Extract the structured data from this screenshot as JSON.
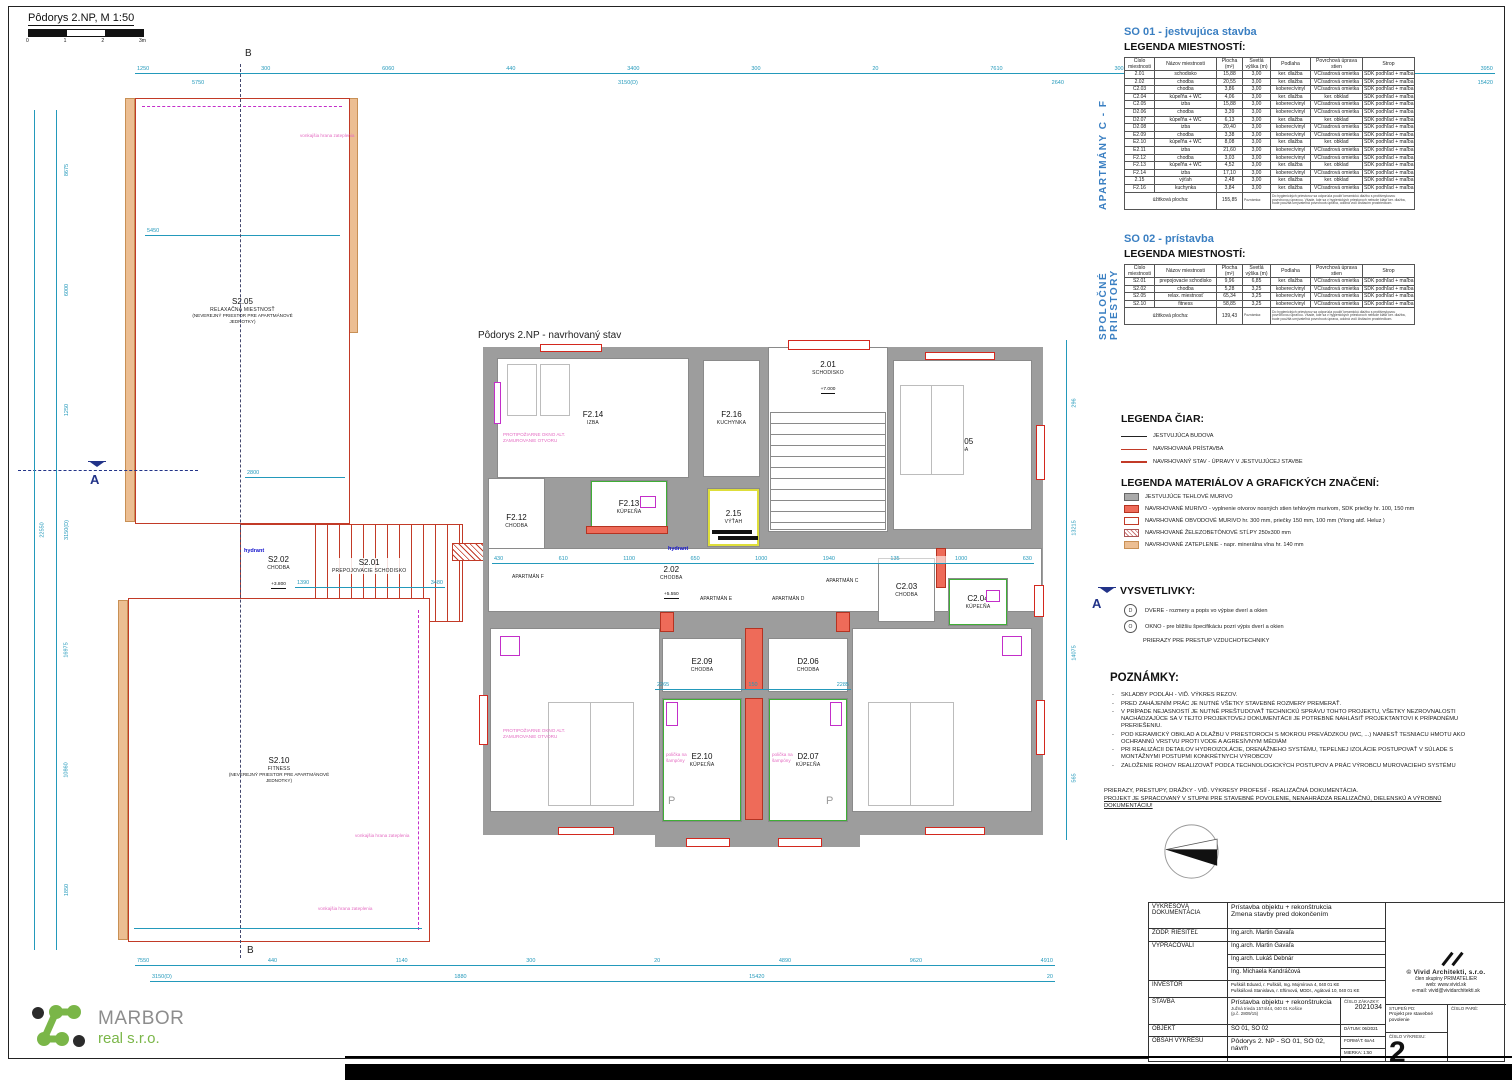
{
  "sheet": {
    "title": "Pôdorys 2.NP, M 1:50",
    "scale_ticks": [
      "0",
      "1",
      "2",
      "3m"
    ],
    "section_a": "A",
    "section_b": "B"
  },
  "plan_left": {
    "rooms": [
      {
        "id": "S2.05",
        "name": "RELAXAČNÁ MIESTNOSŤ",
        "sub": "(NEVEREJNÝ PRIESTOR PRE APARTMÁNOVÉ JEDNOTKY)"
      },
      {
        "id": "S2.02",
        "name": "CHODBA",
        "level": "+3.800"
      },
      {
        "id": "S2.01",
        "name": "PREPOJOVACIE SCHODISKO"
      },
      {
        "id": "S2.10",
        "name": "FITNESS",
        "sub": "(NEVEREJNÝ PRIESTOR PRE APARTMÁNOVÉ JEDNOTKY)"
      }
    ],
    "hydrant": "hydrant",
    "edge_note": "vonkajšia hrana zateplenia"
  },
  "plan_center": {
    "title": "Pôdorys 2.NP - navrhovaný stav",
    "rooms": [
      {
        "id": "F2.14",
        "name": "IZBA"
      },
      {
        "id": "F2.16",
        "name": "KUCHYNKA"
      },
      {
        "id": "2.01",
        "name": "SCHODISKO",
        "level": "+7.000"
      },
      {
        "id": "C2.05",
        "name": "IZBA"
      },
      {
        "id": "F2.12",
        "name": "CHODBA"
      },
      {
        "id": "F2.13",
        "name": "KÚPEĽŇA"
      },
      {
        "id": "2.15",
        "name": "VÝŤAH"
      },
      {
        "id": "2.02",
        "name": "CHODBA",
        "level": "+5.550"
      },
      {
        "id": "C2.03",
        "name": "CHODBA"
      },
      {
        "id": "C2.04",
        "name": "KÚPEĽŇA"
      },
      {
        "id": "E2.11",
        "name": "IZBA"
      },
      {
        "id": "E2.09",
        "name": "CHODBA"
      },
      {
        "id": "D2.06",
        "name": "CHODBA"
      },
      {
        "id": "E2.10",
        "name": "KÚPEĽŇA"
      },
      {
        "id": "D2.07",
        "name": "KÚPEĽŇA"
      },
      {
        "id": "D2.08",
        "name": "IZBA"
      }
    ],
    "apartments": [
      "APARTMÁN F",
      "APARTMÁN E",
      "APARTMÁN D",
      "APARTMÁN C"
    ],
    "hydrant": "hydrant",
    "fire_note": "PROTIPOŽIARNE OKNO ALT. ZAMUROVANIE OTVORU",
    "shelf_note": "polička na šampóny",
    "p_label": "P"
  },
  "dims": {
    "top1": [
      "1250",
      "300",
      "6060",
      "440",
      "3400",
      "300",
      "20",
      "7610",
      "300",
      "3980",
      "970",
      "3950"
    ],
    "top2": [
      "5750",
      "3150(D)",
      "2640",
      "15420"
    ],
    "bottom1": [
      "7550",
      "440",
      "1140",
      "300",
      "20",
      "4890",
      "9620",
      "4910"
    ],
    "bottom2": [
      "3150(D)",
      "1880",
      "15420",
      "20"
    ],
    "left_outer": [
      "22550"
    ],
    "left_inner": [
      "8675",
      "6000",
      "1250",
      "3150(D)",
      "16975",
      "10860",
      "1850"
    ],
    "right_col": [
      "296",
      "13215",
      "14075",
      "565"
    ],
    "corridor": [
      "430",
      "610",
      "1100",
      "650",
      "1000",
      "1940",
      "135",
      "1000",
      "630"
    ],
    "echain": [
      "2265",
      "150",
      "2285"
    ],
    "s205": [
      "5450"
    ],
    "s205b": [
      "2800"
    ],
    "s201": [
      "1390",
      "3480"
    ]
  },
  "so01": {
    "side_label": "APARTMÁNY C - F",
    "title": "SO 01 - jestvujúca stavba",
    "subtitle": "LEGENDA MIESTNOSTÍ:",
    "headers": [
      "Číslo miestnosti",
      "Názov miestnosti",
      "Plocha (m²)",
      "Svetlá výška (m)",
      "Podlaha",
      "Povrchová úprava stien",
      "Strop"
    ],
    "rows": [
      [
        "2.01",
        "schodisko",
        "15,88",
        "3,00",
        "ker. dlažba",
        "VC/sadrová omietka",
        "SDK podhľad + maľba"
      ],
      [
        "2.02",
        "chodba",
        "20,55",
        "3,00",
        "ker. dlažba",
        "VC/sadrová omietka",
        "SDK podhľad + maľba"
      ],
      [
        "C2.03",
        "chodba",
        "3,86",
        "3,00",
        "koberec/vinyl",
        "VC/sadrová omietka",
        "SDK podhľad + maľba"
      ],
      [
        "C2.04",
        "kúpeľňa + WC",
        "4,06",
        "3,00",
        "ker. dlažba",
        "ker. obklad",
        "SDK podhľad + maľba"
      ],
      [
        "C2.05",
        "izba",
        "15,88",
        "3,00",
        "koberec/vinyl",
        "VC/sadrová omietka",
        "SDK podhľad + maľba"
      ],
      [
        "D2.06",
        "chodba",
        "3,39",
        "3,00",
        "koberec/vinyl",
        "VC/sadrová omietka",
        "SDK podhľad + maľba"
      ],
      [
        "D2.07",
        "kúpeľňa + WC",
        "6,13",
        "3,00",
        "ker. dlažba",
        "ker. obklad",
        "SDK podhľad + maľba"
      ],
      [
        "D2.08",
        "izba",
        "20,40",
        "3,00",
        "koberec/vinyl",
        "VC/sadrová omietka",
        "SDK podhľad + maľba"
      ],
      [
        "E2.09",
        "chodba",
        "3,38",
        "3,00",
        "koberec/vinyl",
        "VC/sadrová omietka",
        "SDK podhľad + maľba"
      ],
      [
        "E2.10",
        "kúpeľňa + WC",
        "8,08",
        "3,00",
        "ker. dlažba",
        "ker. obklad",
        "SDK podhľad + maľba"
      ],
      [
        "E2.11",
        "izba",
        "21,60",
        "3,00",
        "koberec/vinyl",
        "VC/sadrová omietka",
        "SDK podhľad + maľba"
      ],
      [
        "F2.12",
        "chodba",
        "3,03",
        "3,00",
        "koberec/vinyl",
        "VC/sadrová omietka",
        "SDK podhľad + maľba"
      ],
      [
        "F2.13",
        "kúpeľňa + WC",
        "4,52",
        "3,00",
        "ker. dlažba",
        "ker. obklad",
        "SDK podhľad + maľba"
      ],
      [
        "F2.14",
        "izba",
        "17,10",
        "3,00",
        "koberec/vinyl",
        "VC/sadrová omietka",
        "SDK podhľad + maľba"
      ],
      [
        "2.15",
        "výťah",
        "2,48",
        "3,00",
        "ker. dlažba",
        "ker. obklad",
        "SDK podhľad + maľba"
      ],
      [
        "F2.16",
        "kuchynka",
        "3,84",
        "3,00",
        "ker. dlažba",
        "VC/sadrová omietka",
        "SDK podhľad + maľba"
      ]
    ],
    "footer_label": "úžitková plocha:",
    "footer_value": "155,85",
    "note_label": "Poznámka:",
    "note": "Do hygienických priestorov sa odporúča použiť keramickú dlažbu s protišmykovou povrchovou úpravou. Všade, kde sa v hygienických priestoroch nebude klásť ker. dlažba, bude použitá umývateľná povrchová úprava, odolná voči čistiacim prostriedkom."
  },
  "so02": {
    "side_label": "SPOLOČNÉ PRIESTORY",
    "title": "SO 02 - prístavba",
    "subtitle": "LEGENDA MIESTNOSTÍ:",
    "headers": [
      "Číslo miestnosti",
      "Názov miestnosti",
      "Plocha (m²)",
      "Svetlá výška (m)",
      "Podlaha",
      "Povrchová úprava stien",
      "Strop"
    ],
    "rows": [
      [
        "S2.01",
        "prepojovacie schodisko",
        "9,96",
        "6,85",
        "ker. dlažba",
        "VC/sadrová omietka",
        "SDK podhľad + maľba"
      ],
      [
        "S2.02",
        "chodba",
        "5,28",
        "3,25",
        "koberec/vinyl",
        "VC/sadrová omietka",
        "SDK podhľad + maľba"
      ],
      [
        "S2.05",
        "relax. miestnosť",
        "65,34",
        "3,25",
        "koberec/vinyl",
        "VC/sadrová omietka",
        "SDK podhľad + maľba"
      ],
      [
        "S2.10",
        "fitness",
        "58,85",
        "3,25",
        "koberec/vinyl",
        "VC/sadrová omietka",
        "SDK podhľad + maľba"
      ]
    ],
    "footer_label": "úžitková plocha:",
    "footer_value": "139,43",
    "note_label": "Poznámka:",
    "note": "Do hygienických priestorov sa odporúča použiť keramickú dlažbu s protišmykovou povrchovou úpravou. Všade, kde sa v hygienických priestoroch nebude klásť ker. dlažba, bude použitá umývateľná povrchová úprava, odolná voči čistiacim prostriedkom."
  },
  "legend_lines": {
    "title": "LEGENDA ČIAR:",
    "items": [
      "JESTVUJÚCA BUDOVA",
      "NAVRHOVANÁ PRÍSTAVBA",
      "NAVRHOVANÝ STAV - ÚPRAVY V JESTVUJÚCEJ STAVBE"
    ]
  },
  "legend_materials": {
    "title": "LEGENDA MATERIÁLOV A GRAFICKÝCH ZNAČENÍ:",
    "items": [
      "JESTVUJÚCE TEHLOVÉ MURIVO",
      "NAVRHOVANÉ MURIVO - vyplnenie otvorov nosných stien tehlovým murivom, SDK priečky hr. 100, 150 mm",
      "NAVRHOVANÉ OBVODOVÉ MURIVO hr. 300 mm, priečky 150 mm, 100 mm (Ytong atď. Heluz )",
      "NAVRHOVANÉ ŽELEZOBETÓNOVÉ STĹPY 250x300 mm",
      "NAVRHOVANÉ ZATEPLENIE - napr. minerálna vlna hr. 140 mm"
    ]
  },
  "vysvetlivky": {
    "title": "VYSVETLIVKY:",
    "door_symbol": "D",
    "door_text": "DVERE - rozmery a popis vo výpise dverí a okien",
    "window_symbol": "O",
    "window_text": "OKNO - pre bližšiu špecifikáciu pozri výpis dverí a okien",
    "extra": "PRIERAZY PRE PRESTUP VZDUCHOTECHNIKY"
  },
  "notes": {
    "title": "POZNÁMKY:",
    "items": [
      "SKLADBY PODLÁH - VIĎ. VÝKRES REZOV.",
      "PRED ZAHÁJENÍM PRÁC JE NUTNÉ VŠETKY STAVEBNÉ ROZMERY PREMERAŤ.",
      "V PRÍPADE NEJASNOSTÍ JE NUTNÉ PREŠTUDOVAŤ TECHNICKÚ SPRÁVU TOHTO PROJEKTU, VŠETKY NEZROVNALOSTI NACHÁDZAJÚCE SA V TEJTO PROJEKTOVEJ DOKUMENTÁCII JE POTREBNÉ NAHLÁSIŤ PROJEKTANTOVI K PRÍPADNÉMU PRERIEŠENIU.",
      "POD KERAMICKÝ OBKLAD A DLAŽBU V PRIESTOROCH S MOKROU PREVÁDZKOU (WC, ...) NANIESŤ TESNIACU HMOTU AKO OCHRANNÚ VRSTVU PROTI VODE A AGRESÍVNYM MÉDIÁM",
      "PRI REALIZÁCII DETAILOV HYDROIZOLÁCIE, DRENÁŽNEHO SYSTÉMU, TEPELNEJ IZOLÁCIE POSTUPOVAŤ V SÚLADE S MONTÁŽNYMI POSTUPMI KONKRÉTNYCH VÝROBCOV",
      "ZALOŽENIE ROHOV REALIZOVAŤ PODĽA TECHNOLOGICKÝCH POSTUPOV A PRÁC VÝROBCU MUROVACIEHO SYSTÉMU"
    ],
    "footer1": "PRIERAZY, PRESTUPY, DRÁŽKY - VIĎ. VÝKRESY PROFESIÍ - REALIZAČNÁ DOKUMENTÁCIA.",
    "footer2": "PROJEKT JE SPRACOVANÝ V STUPNI PRE STAVEBNÉ POVOLENIE, NENAHRÁDZA REALIZAČNÚ, DIELENSKÚ A VÝROBNÚ DOKUMENTÁCIU!"
  },
  "titleblock": {
    "doc_label": "VÝKRESOVÁ DOKUMENTÁCIA",
    "doc_value1": "Prístavba objektu + rekonštrukcia",
    "doc_value2": "Zmena stavby pred dokončením",
    "zodp_label": "ZODP. RIEŠITEĽ",
    "zodp_value": "Ing.arch. Martin Gavaľa",
    "vyp_label": "VYPRACOVALI",
    "vyp1": "Ing.arch. Martin Gavaľa",
    "vyp2": "Ing.arch. Lukáš Debnár",
    "vyp3": "Ing. Michaela Kandráčová",
    "inv_label": "INVESTOR",
    "inv1": "Puškáš Eduard, r. Puškáš, Ing. Mojmírova 4, 040 01 KE",
    "inv2": "Puškášová Stanislava, r. Eftimová, MDDr., Agátová 10, 040 01 KE",
    "stavba_label": "STAVBA",
    "stavba1": "Prístavba objektu + rekonštrukcia",
    "stavba2": "Južná trieda 1574/44, 040 01 Košice",
    "stavba3": "(p.č. 2809/15)",
    "zakazka_label": "ČÍSLO ZÁKAZKY:",
    "zakazka": "2021034",
    "objekt_label": "OBJEKT",
    "objekt": "SO 01, SO 02",
    "datum_label": "DÁTUM:",
    "datum": "06/2021",
    "obsah_label": "OBSAH VÝKRESU",
    "obsah": "Pôdorys 2. NP - SO 01, SO 02, návrh",
    "format_label": "FORMÁT:",
    "format": "6xA4",
    "mierka_label": "MIERKA:",
    "mierka": "1:50",
    "firm_name": "© Vivid Architekti, s.r.o.",
    "firm_member": "člen skupiny PRIMATELIER",
    "firm_web": "web: www.vivid.sk",
    "firm_email": "e-mail: vivid@vividarchitekti.sk",
    "stupen_label": "STUPEŇ PD:",
    "stupen": "Projekt pre stavebné povolenie",
    "cislo_vykresu_label": "ČÍSLO VÝKRESU:",
    "cislo_vykresu": "2",
    "pare_label": "ČÍSLO PARÉ:"
  },
  "logo": {
    "name": "MARBOR",
    "sub": "real s.r.o."
  }
}
